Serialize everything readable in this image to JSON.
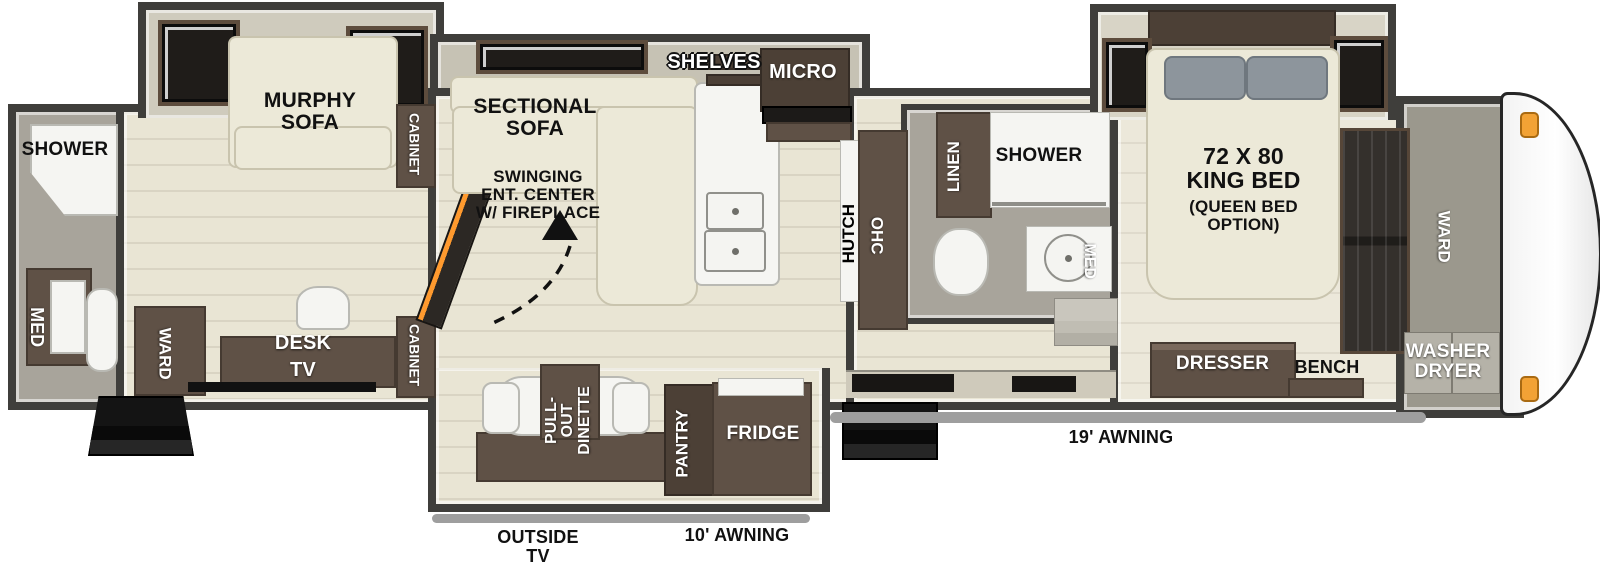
{
  "floorplan": {
    "rear_bath": {
      "shower_label": "SHOWER",
      "med_label": "MED"
    },
    "rear_room": {
      "murphy_sofa_label": "MURPHY\nSOFA",
      "ward_label": "WARD",
      "desk_tv_label": "DESK\nTV",
      "cabinet_top_label": "CABINET",
      "cabinet_bottom_label": "CABINET"
    },
    "living": {
      "sectional_sofa_label": "SECTIONAL\nSOFA",
      "swinging_ent_center_label": "SWINGING\nENT. CENTER\nW/ FIREPLACE",
      "shelves_label": "SHELVES",
      "micro_label": "MICRO",
      "hutch_label": "HUTCH",
      "ohc_label": "OHC"
    },
    "dinette_slide": {
      "pullout_dinette_label": "PULL-OUT\nDINETTE",
      "pantry_label": "PANTRY",
      "fridge_label": "FRIDGE"
    },
    "mid_bath": {
      "linen_label": "LINEN",
      "shower_label": "SHOWER",
      "med_label": "MED"
    },
    "bedroom": {
      "bed_size_label": "72 X 80\nKING BED",
      "bed_option_label": "(QUEEN BED\nOPTION)",
      "dresser_label": "DRESSER",
      "bench_label": "BENCH"
    },
    "front": {
      "ward_label": "WARD",
      "washer_dryer_label": "WASHER\nDRYER"
    },
    "exterior": {
      "awning_19_label": "19' AWNING",
      "awning_10_label": "10' AWNING",
      "outside_tv_label": "OUTSIDE\nTV"
    }
  },
  "colors": {
    "wall": "#3f3e3b",
    "wood_floor": "#e9e5d4",
    "bath_floor": "#a8a49b",
    "cabinet_brown": "#5f5146",
    "cream_upholstery": "#ece9d8",
    "pillow_gray": "#8d959c",
    "awning_gray": "#9e9e9e",
    "marker_orange": "#f2a235",
    "steps_black": "#141414",
    "text_dark": "#111111",
    "text_light": "#ffffff"
  }
}
